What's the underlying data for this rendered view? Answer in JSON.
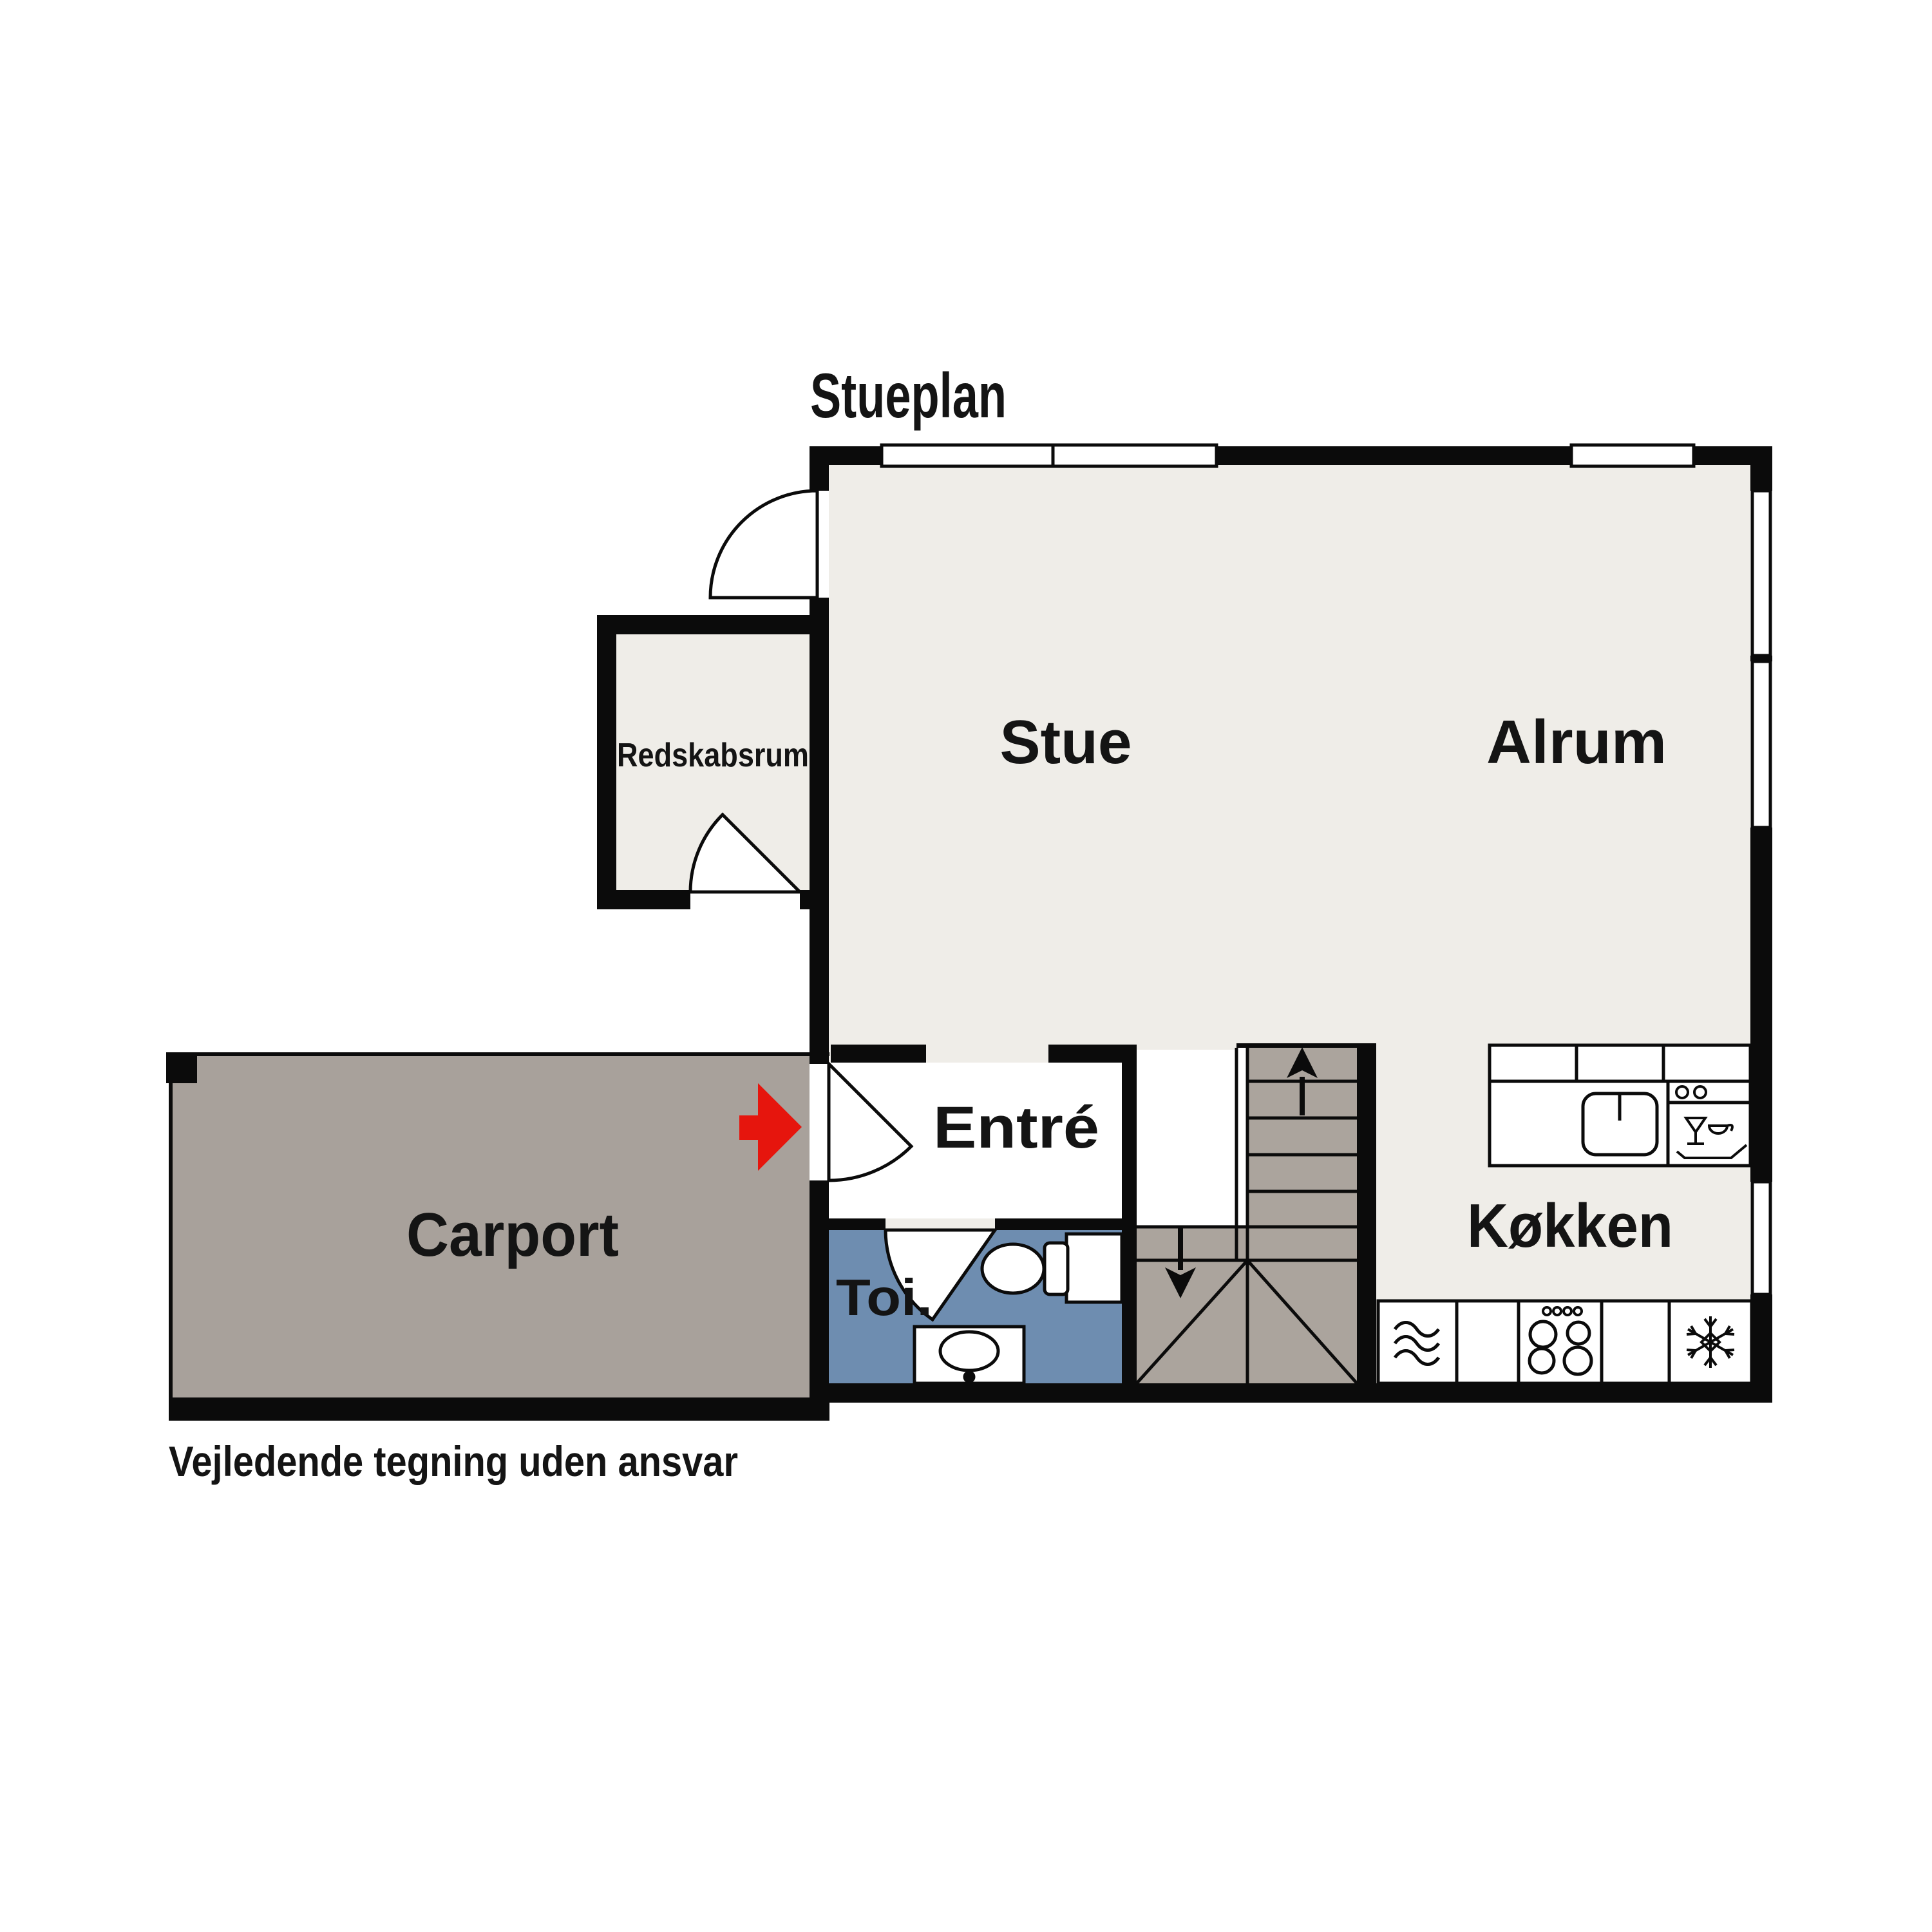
{
  "labels": {
    "title": "Stueplan",
    "stue": "Stue",
    "alrum": "Alrum",
    "redskabsrum": "Redskabsrum",
    "carport": "Carport",
    "entre": "Entré",
    "toilet": "Toi.",
    "kitchen": "Køkken",
    "disclaimer": "Vejledende tegning uden ansvar"
  },
  "colors": {
    "wall": "#0b0b0b",
    "floor": "#efede8",
    "carport": "#a8a19b",
    "stairs": "#aba49d",
    "toilet_room": "#6e8db0",
    "entrance_arrow": "#e6150d",
    "white": "#ffffff"
  },
  "icons": {
    "entrance_arrow": "red-right-arrow",
    "stairs_up": "arrow-up",
    "stairs_down": "arrow-down",
    "stove": "four-burner-cooktop",
    "oven": "three-waves",
    "fridge": "snowflake",
    "dishwasher": "glass-and-cup-on-tray",
    "kitchen_sink": "rounded-basin-with-tap",
    "toilet": "toilet-bowl-and-cistern",
    "washbasin": "oval-basin-with-tap"
  }
}
